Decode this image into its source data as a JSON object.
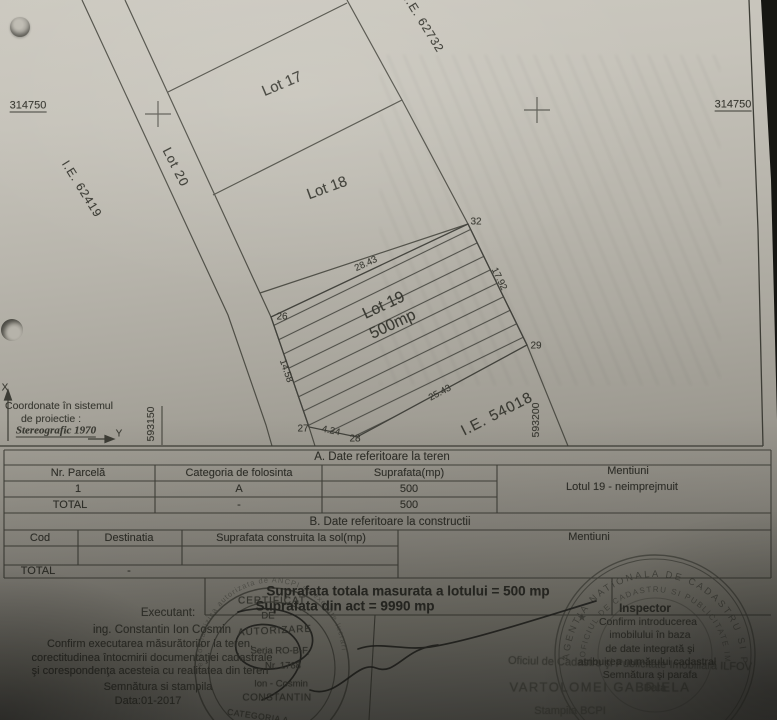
{
  "colors": {
    "paper": "#c7c4bb",
    "ink": "#3a3a34",
    "background": "#141412"
  },
  "plan": {
    "lot17": "Lot 17",
    "lot18": "Lot 18",
    "lot19": "Lot 19",
    "lot19_area": "500mp",
    "lot20": "Lot 20",
    "ie_62419": "I.E. 62419",
    "ie_62732": "I.E. 62732",
    "ie_54018": "I.E. 54018",
    "grid_x_left": "314750",
    "grid_x_right": "314750",
    "grid_y1": "593150",
    "grid_y2": "593200",
    "v26": "26",
    "v27": "27",
    "v28": "28",
    "v29": "29",
    "v32": "32",
    "d26_32": "28.43",
    "d32_29": "17.92",
    "d29_28": "25.43",
    "d27_28": "4.24",
    "d26_27": "14.58",
    "legend1": "Coordonate în sistemul",
    "legend2": "de proiectie :",
    "legend3": "Stereografic 1970",
    "axis_x": "X",
    "axis_y": "Y"
  },
  "table_a": {
    "title": "A. Date referitoare la teren",
    "h1": "Nr. Parcelă",
    "h2": "Categoria de folosinta",
    "h3": "Suprafata(mp)",
    "h4": "Mentiuni",
    "r1c1": "1",
    "r1c2": "A",
    "r1c3": "500",
    "r1c4": "Lotul 19 - neimprejmuit",
    "t1": "TOTAL",
    "t2": "-",
    "t3": "500"
  },
  "table_b": {
    "title": "B. Date referitoare la constructii",
    "h1": "Cod",
    "h2": "Destinatia",
    "h3": "Suprafata construita la sol(mp)",
    "h4": "Mentiuni",
    "t1": "TOTAL",
    "t2": "-"
  },
  "summary": {
    "measured": "Suprafata totala masurata a lotului = 500 mp",
    "act": "Suprafata din act = 9990 mp"
  },
  "executant": {
    "label": "Executant:",
    "name": "ing. Constantin Ion Cosmin",
    "conf1": "Confirm executarea măsurătorilor la teren,",
    "conf2": "corectitudinea întocmirii documentaţiei cadastrale",
    "conf3": "şi corespondenţa acesteia cu realitatea din teren",
    "sign": "Semnătura si stampila",
    "date": "Data:01-2017"
  },
  "inspector": {
    "title": "Inspector",
    "conf1": "Confirm introducerea",
    "conf2": "imobilului în baza",
    "conf3": "de date integrată şi",
    "conf4": "atribuirea numărului cadastral",
    "sign": "Semnătura şi parafa",
    "date": "Data",
    "office": "Oficiul de Cadastru şi Publicitate Imobiliară ILFOV",
    "name": "VARTOLOMEI GABRIELA",
    "bcpi": "Stampila BCPI"
  },
  "stamp_cert": {
    "l1": "CERTIFICAT",
    "l2": "DE",
    "l3": "AUTORIZARE",
    "l4": "Seria RO-B-F,",
    "l5": "Nr. 1768",
    "l6": "Ion - Cosmin",
    "l7": "CONSTANTIN",
    "l8": "CATEGORIA A",
    "rim": "persoana fizica autorizata de ANCPI sa execute lucrari"
  },
  "stamp_ocpi": {
    "outer": "AGENTIA NATIONALA DE CADASTRU SI PUBLICITATE IMOBILIARA",
    "inner": "OFICIUL DE CADASTRU SI PUBLICITATE IMOBILIARA ILFOV",
    "star": "★"
  }
}
